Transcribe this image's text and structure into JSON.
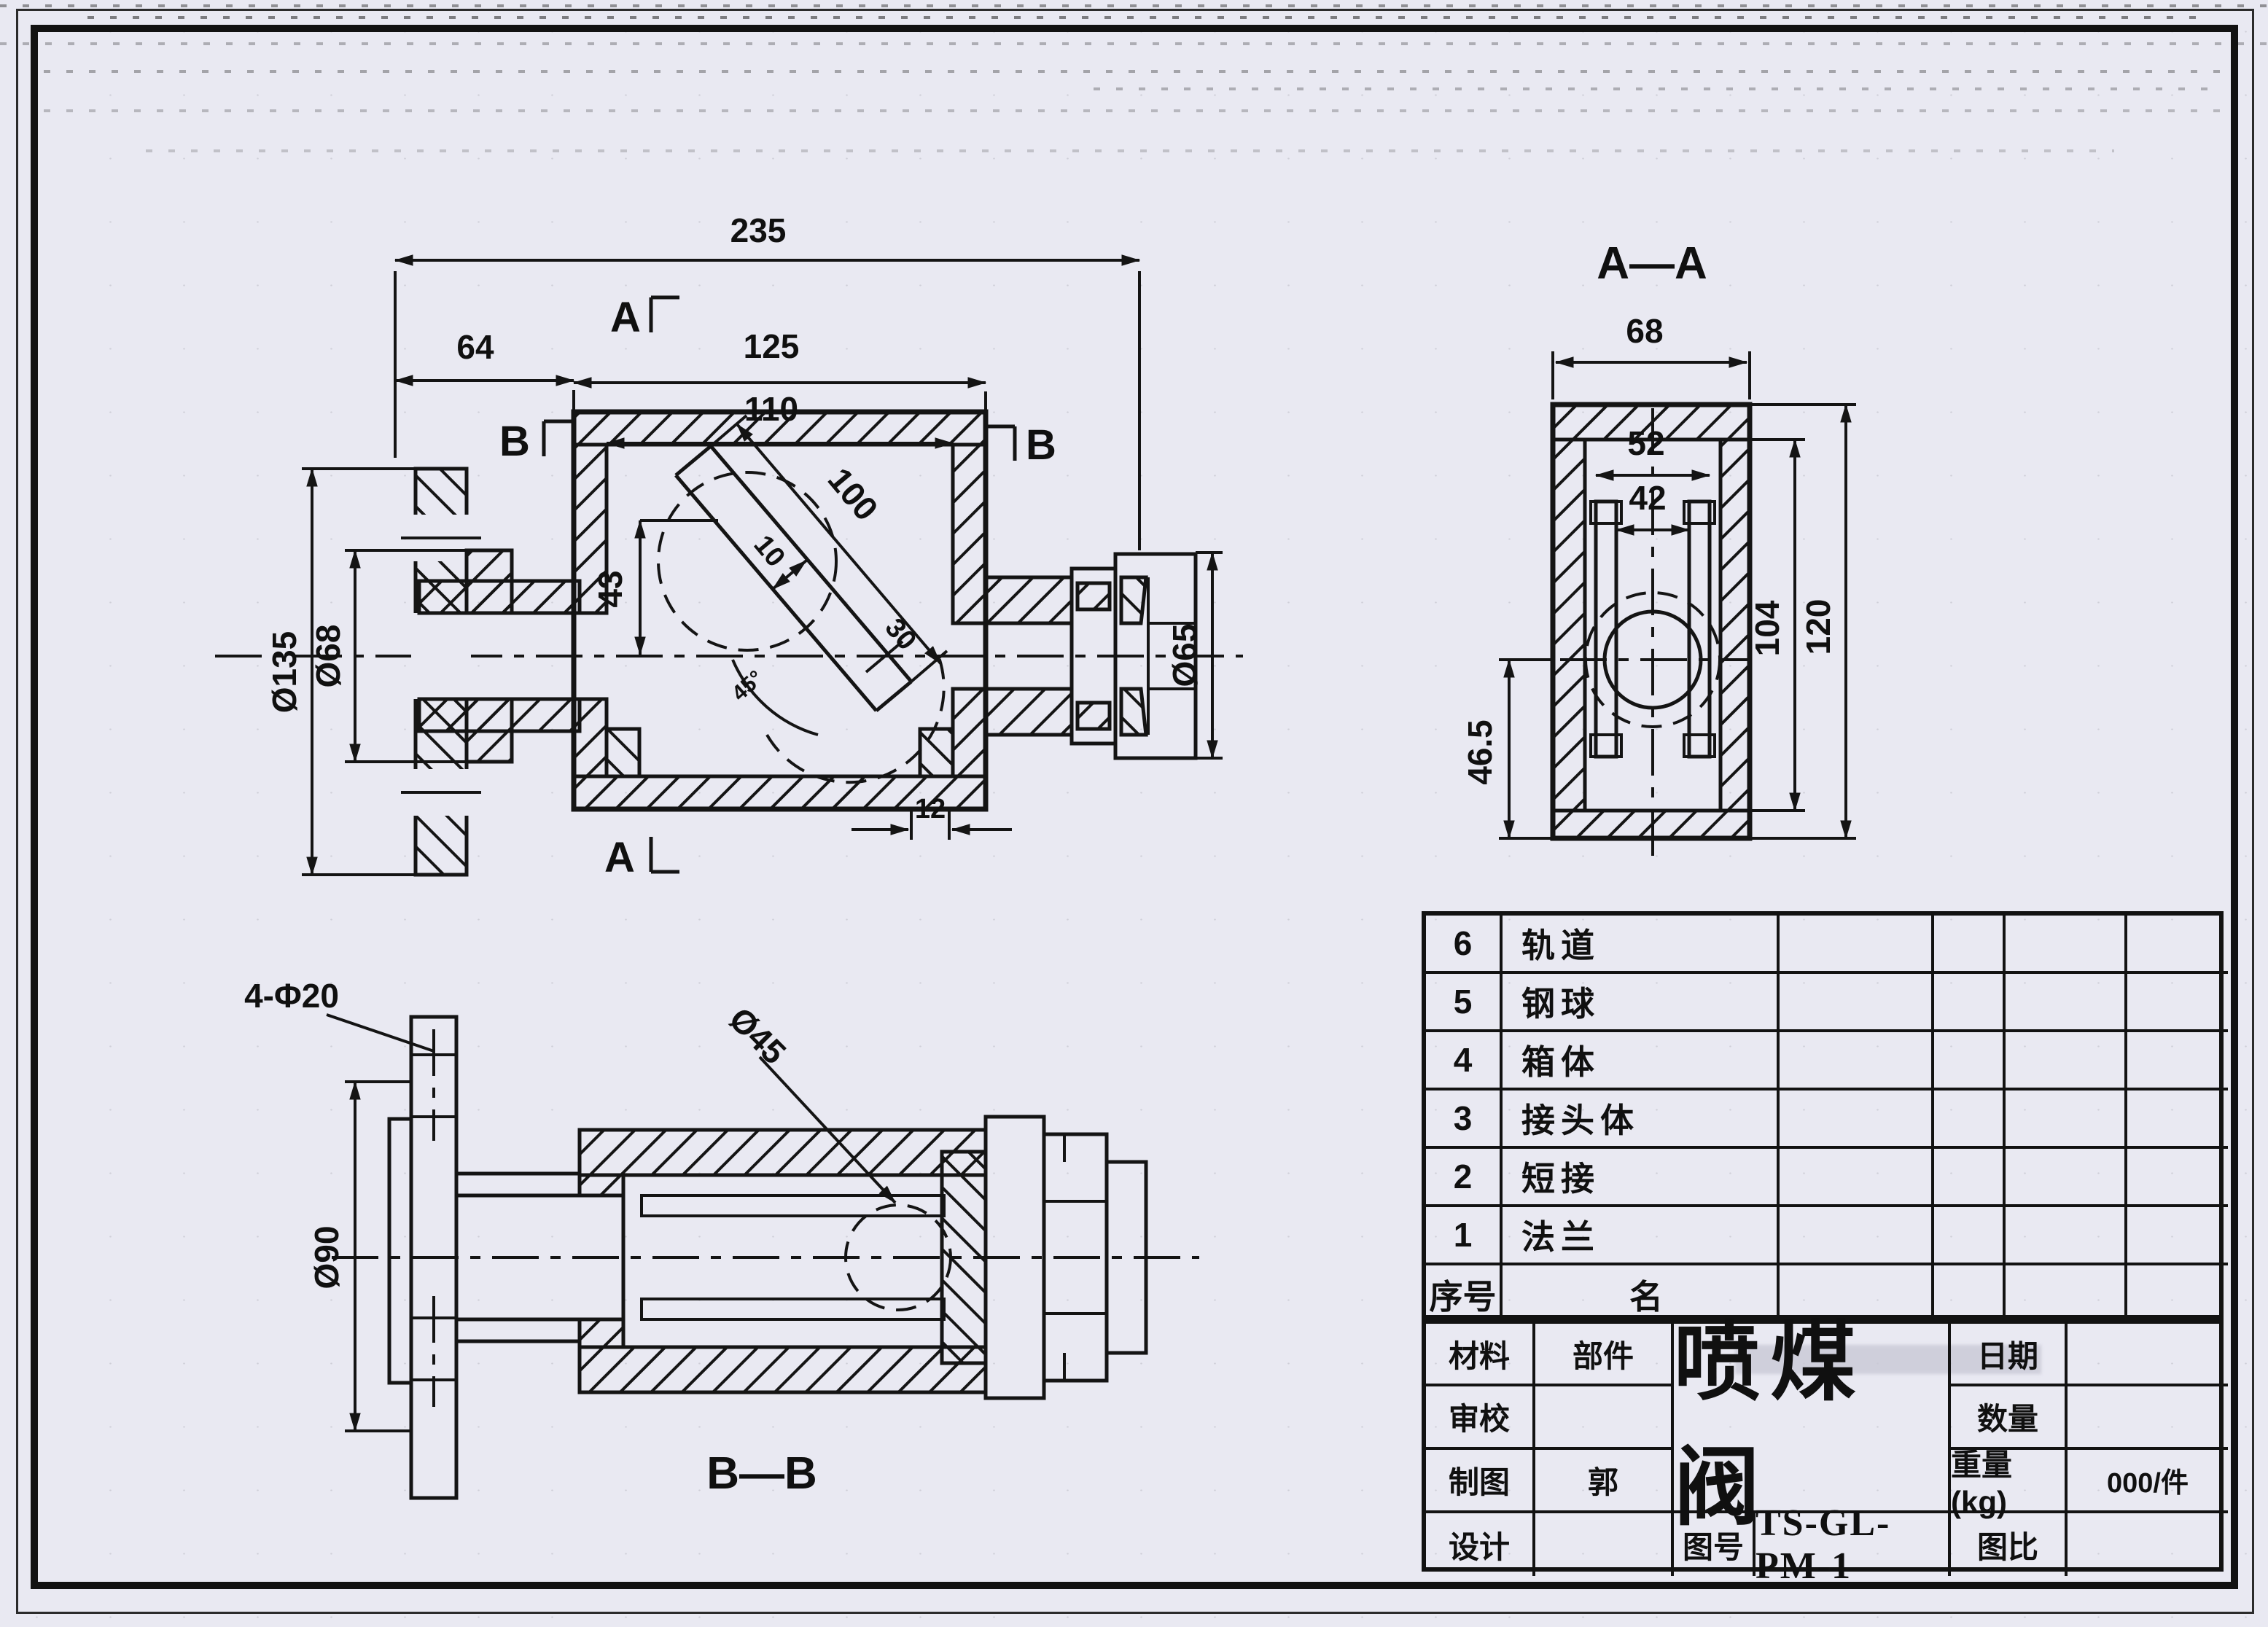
{
  "front": {
    "dim_total": "235",
    "dim_left": "64",
    "dim_outer": "125",
    "dim_inner": "110",
    "dim_bore_len": "100",
    "dim_bore_w": "10",
    "dim_offset": "43",
    "dim_exit_w": "30",
    "dim_step": "12",
    "dim_flange_od": "Ø135",
    "dim_hub": "Ø68",
    "dim_joint": "Ø65",
    "dim_angle": "45°",
    "mark_a_top": "A",
    "mark_a_bottom": "A",
    "mark_b_left": "B",
    "mark_b_right": "B"
  },
  "section_aa": {
    "title": "A—A",
    "dim_width": "68",
    "dim_rail_outer": "52",
    "dim_rail_inner": "42",
    "dim_cavity_h": "104",
    "dim_total_h": "120",
    "dim_seat": "46.5"
  },
  "section_bb": {
    "title": "B—B",
    "dim_bolt_holes": "4-Φ20",
    "dim_flange_od": "Ø90",
    "dim_ball": "Ø45"
  },
  "parts_table": {
    "header": {
      "no": "序号",
      "name": "名"
    },
    "rows": [
      {
        "no": "6",
        "name": "轨道"
      },
      {
        "no": "5",
        "name": "钢球"
      },
      {
        "no": "4",
        "name": "箱体"
      },
      {
        "no": "3",
        "name": "接头体"
      },
      {
        "no": "2",
        "name": "短接"
      },
      {
        "no": "1",
        "name": "法兰"
      }
    ]
  },
  "title_block": {
    "material_label": "材料",
    "component_label": "部件",
    "review_label": "审校",
    "draft_label": "制图",
    "draft_name": "郭",
    "design_label": "设计",
    "drawing_title": "喷煤阀",
    "drawing_no_label": "图号",
    "drawing_no": "TS-GL-PM-1",
    "date_label": "日期",
    "quantity_label": "数量",
    "weight_label": "重量(kg)",
    "weight_value": "000/件",
    "scale_label": "图比"
  }
}
